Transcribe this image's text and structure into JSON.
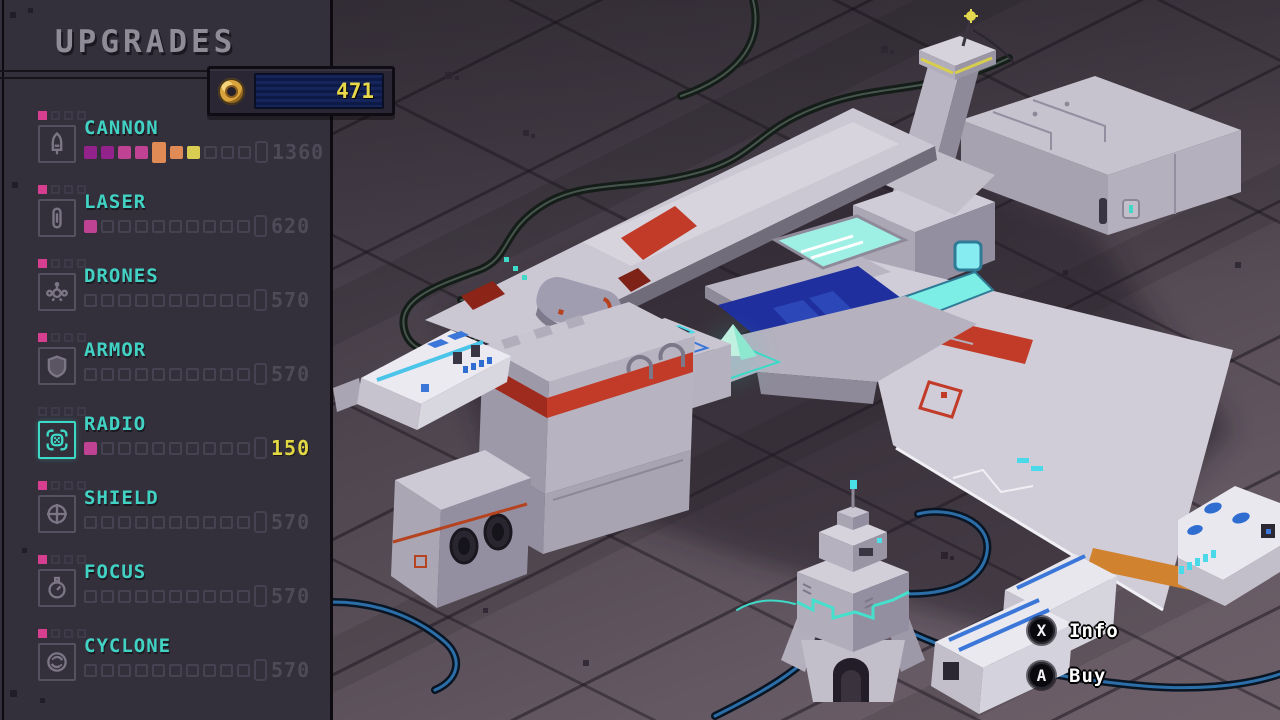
{
  "title": "UPGRADES",
  "currency": {
    "amount": "471",
    "icon": "coin-icon"
  },
  "upgrades": [
    {
      "name": "CANNON",
      "price": "1360",
      "icon": "cannon",
      "tier_filled": 1,
      "selected": false,
      "highlight_price": false,
      "pips": [
        "m1",
        "m1",
        "m2",
        "m2",
        "tall-o",
        "o",
        "y",
        "e",
        "e",
        "e",
        "end"
      ]
    },
    {
      "name": "LASER",
      "price": "620",
      "icon": "laser",
      "tier_filled": 1,
      "selected": false,
      "highlight_price": false,
      "pips": [
        "m2",
        "e",
        "e",
        "e",
        "e",
        "e",
        "e",
        "e",
        "e",
        "e",
        "end"
      ]
    },
    {
      "name": "DRONES",
      "price": "570",
      "icon": "drones",
      "tier_filled": 1,
      "selected": false,
      "highlight_price": false,
      "pips": [
        "e",
        "e",
        "e",
        "e",
        "e",
        "e",
        "e",
        "e",
        "e",
        "e",
        "end"
      ]
    },
    {
      "name": "ARMOR",
      "price": "570",
      "icon": "armor",
      "tier_filled": 1,
      "selected": false,
      "highlight_price": false,
      "pips": [
        "e",
        "e",
        "e",
        "e",
        "e",
        "e",
        "e",
        "e",
        "e",
        "e",
        "end"
      ]
    },
    {
      "name": "RADIO",
      "price": "150",
      "icon": "radio",
      "tier_filled": 0,
      "selected": true,
      "highlight_price": true,
      "pips": [
        "m2",
        "e",
        "e",
        "e",
        "e",
        "e",
        "e",
        "e",
        "e",
        "e",
        "end"
      ]
    },
    {
      "name": "SHIELD",
      "price": "570",
      "icon": "shield",
      "tier_filled": 1,
      "selected": false,
      "highlight_price": false,
      "pips": [
        "e",
        "e",
        "e",
        "e",
        "e",
        "e",
        "e",
        "e",
        "e",
        "e",
        "end"
      ]
    },
    {
      "name": "FOCUS",
      "price": "570",
      "icon": "focus",
      "tier_filled": 1,
      "selected": false,
      "highlight_price": false,
      "pips": [
        "e",
        "e",
        "e",
        "e",
        "e",
        "e",
        "e",
        "e",
        "e",
        "e",
        "end"
      ]
    },
    {
      "name": "CYCLONE",
      "price": "570",
      "icon": "cyclone",
      "tier_filled": 1,
      "selected": false,
      "highlight_price": false,
      "pips": [
        "e",
        "e",
        "e",
        "e",
        "e",
        "e",
        "e",
        "e",
        "e",
        "e",
        "end"
      ]
    }
  ],
  "hints": [
    {
      "button": "X",
      "label": "Info"
    },
    {
      "button": "A",
      "label": "Buy"
    }
  ],
  "colors": {
    "sidebar_bg": "#332f3b",
    "accent_teal": "#3ed9c6",
    "label_cyan": "#42d2c4",
    "price_dim": "#4e4a58",
    "price_highlight": "#e0d743",
    "pip_magenta_dark": "#93228b",
    "pip_magenta": "#c04393",
    "pip_orange": "#e08b55",
    "pip_yellow": "#d9ce52",
    "mini_pip_pink": "#d63f8f",
    "currency_text": "#e8d84b",
    "hull_light": "#cfccd7",
    "red_stripe": "#c23b28",
    "orange_stripe": "#d0822f",
    "canopy_blue": "#1f2f9e",
    "glass_cyan": "#8beee6"
  }
}
